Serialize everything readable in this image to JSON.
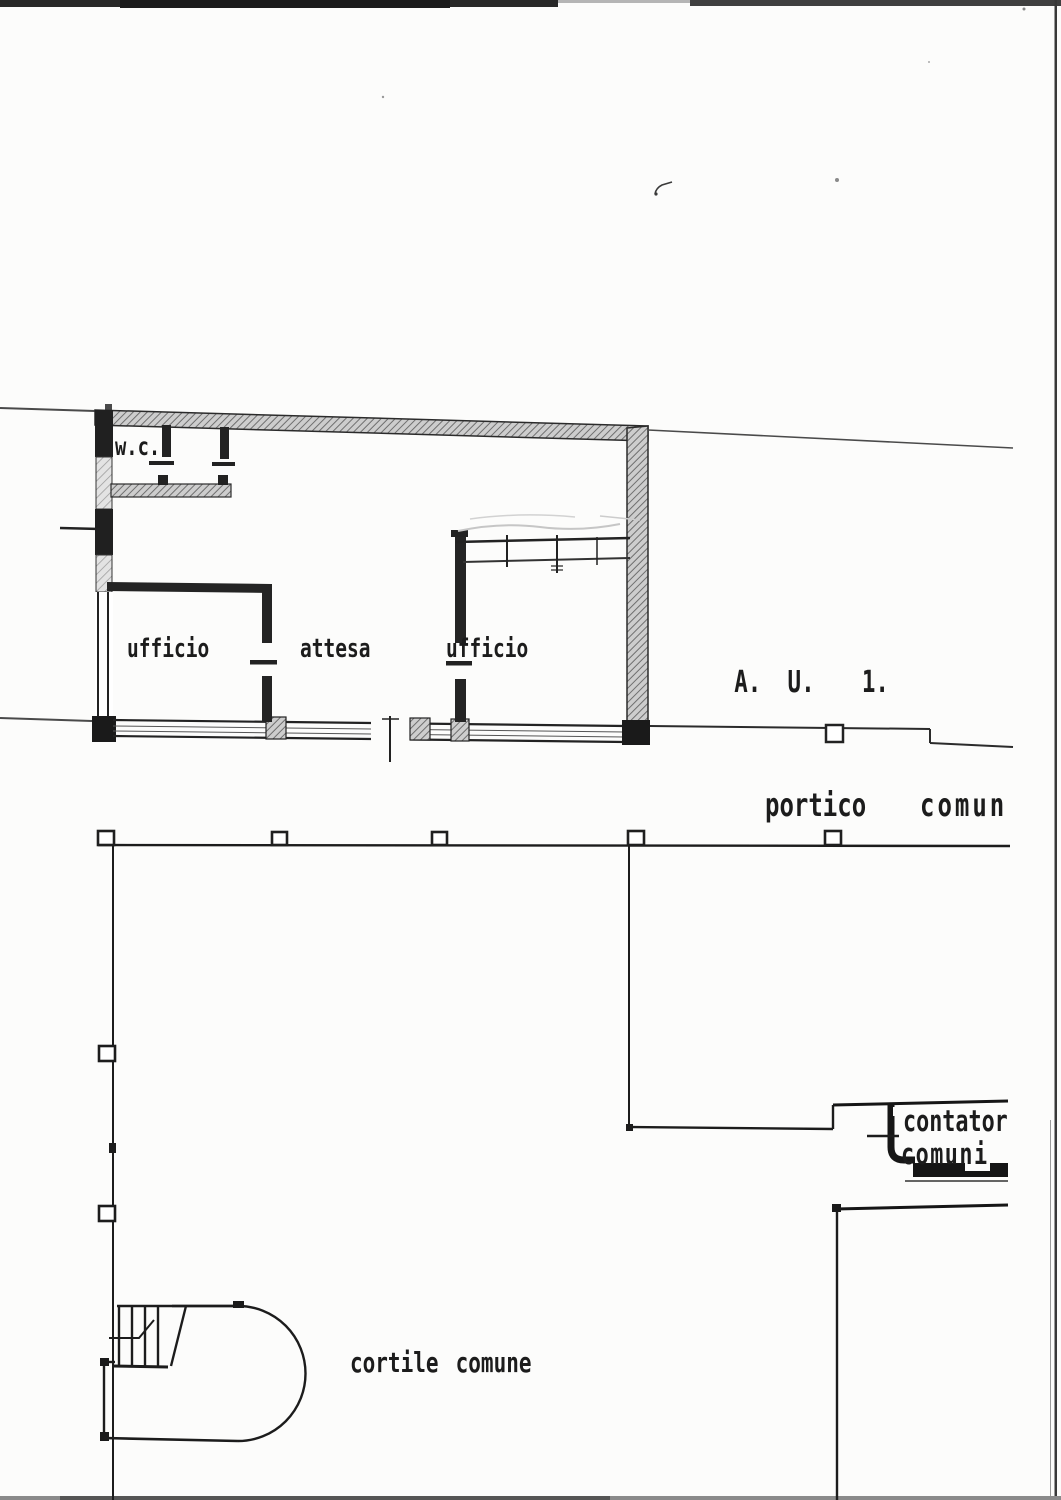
{
  "labels": {
    "wc": "w.c.",
    "office_left": "ufficio",
    "waiting": "attesa",
    "office_right": "ufficio",
    "unit_code": {
      "p1": "A.",
      "p2": "U.",
      "p3": "1."
    },
    "portico_word1": "portico",
    "portico_word2": "comun",
    "meters_line1": "contator",
    "meters_line2": "comuni",
    "courtyard": "cortile comune"
  },
  "colors": {
    "ink": "#1c1c1c",
    "paper": "#fcfcfb",
    "wall_hatch": "#6f6f6f",
    "scan_edge_dark": "#282828",
    "scan_edge_mid": "#3f3f3f"
  }
}
